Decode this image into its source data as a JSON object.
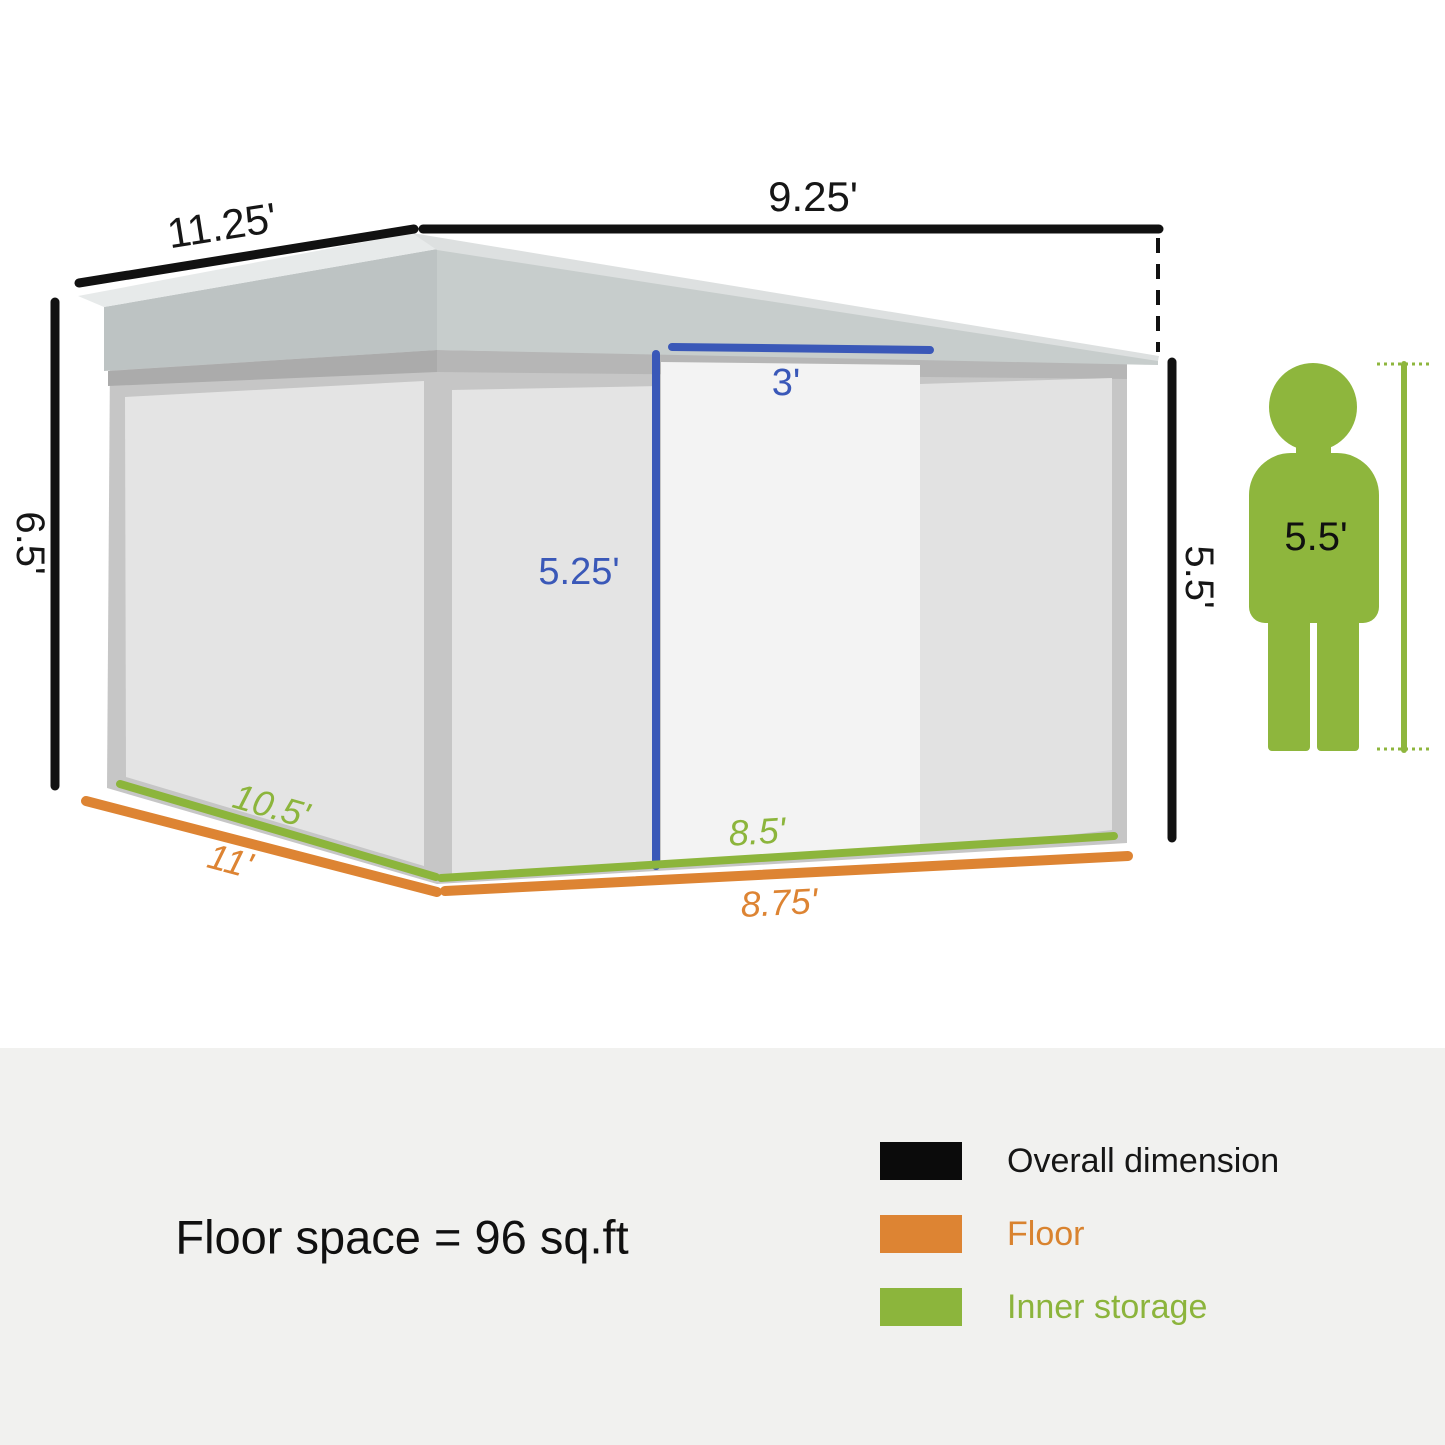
{
  "shed": {
    "overall_dimensions": {
      "roof_left": "11.25'",
      "roof_right": "9.25'",
      "height_left": "6.5'",
      "height_right": "5.5'"
    },
    "door": {
      "width": "3'",
      "height": "5.25'"
    },
    "inner_storage": {
      "left": "10.5'",
      "right": "8.5'"
    },
    "floor": {
      "left": "11'",
      "right": "8.75'"
    },
    "person": {
      "height": "5.5'"
    }
  },
  "footer": {
    "floor_space_text": "Floor space = 96 sq.ft",
    "legend": [
      {
        "label": "Overall dimension",
        "color": "#0b0b0b"
      },
      {
        "label": "Floor",
        "color": "#dd8433"
      },
      {
        "label": "Inner storage",
        "color": "#8cb53c"
      }
    ]
  },
  "colors": {
    "overall_dimension_line": "#111111",
    "floor_line": "#dd8433",
    "inner_storage_line": "#8cb53c",
    "door_dimension_line": "#3a58b8",
    "person_figure": "#8eb63d"
  }
}
